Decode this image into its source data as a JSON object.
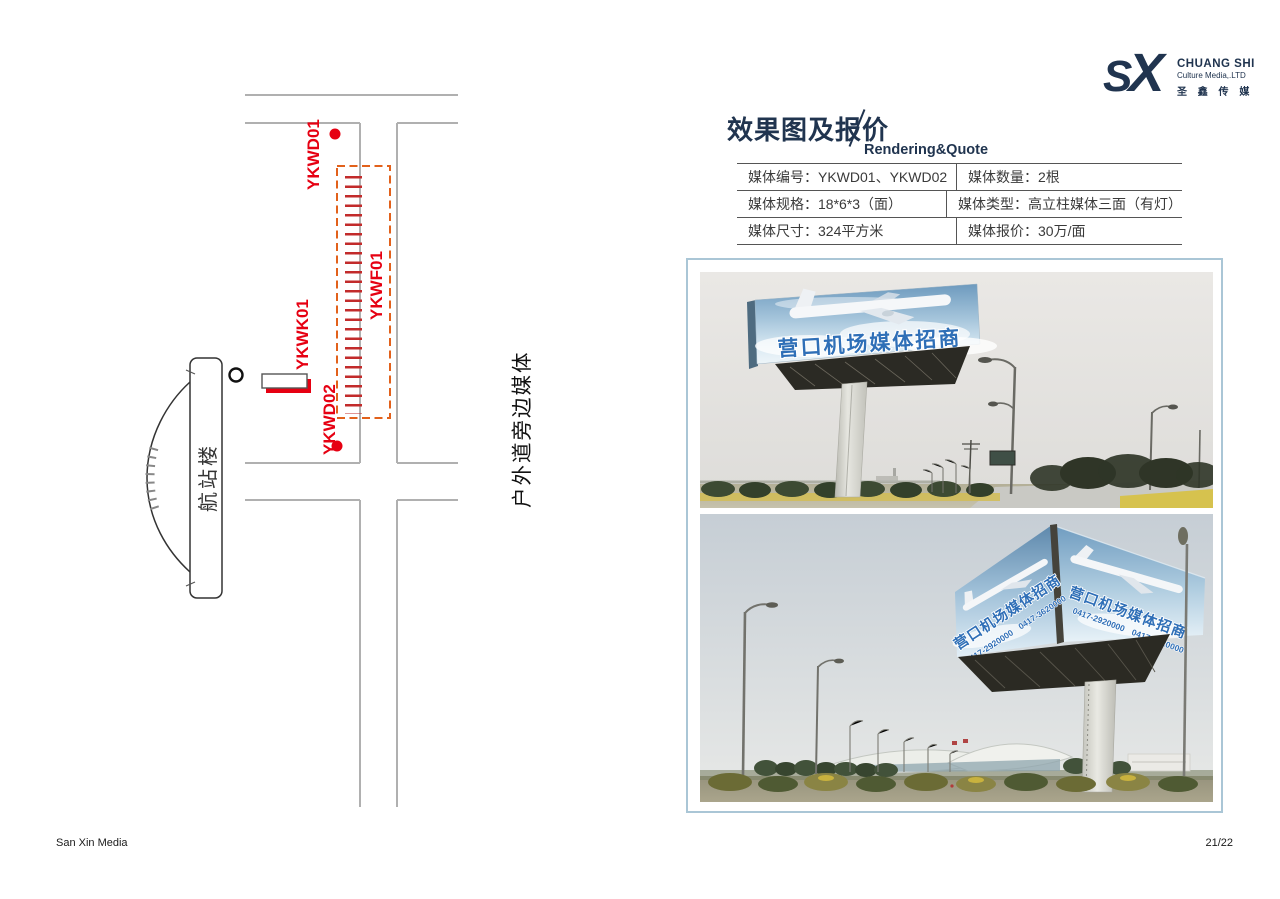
{
  "page": {
    "footer_left": "San Xin Media",
    "page_number": "21/22"
  },
  "logo": {
    "monogram_s": "S",
    "monogram_x": "X",
    "company_en": "CHUANG SHI",
    "company_sub": "Culture Media,.LTD",
    "company_zh": "圣 鑫 传 媒",
    "color": "#20344f"
  },
  "header": {
    "title_zh": "效果图及报价",
    "title_en": "Rendering&Quote"
  },
  "quote_table": {
    "rows": [
      {
        "l_label": "媒体编号：",
        "l_value": "YKWD01、YKWD02",
        "r_label": "媒体数量：",
        "r_value": "2根"
      },
      {
        "l_label": "媒体规格：",
        "l_value": "18*6*3（面）",
        "r_label": "媒体类型：",
        "r_value": "高立柱媒体三面（有灯）"
      },
      {
        "l_label": "媒体尺寸：",
        "l_value": "324平方米",
        "r_label": "媒体报价：",
        "r_value": "30万/面"
      }
    ]
  },
  "map": {
    "labels": {
      "point1": "YKWD01",
      "fence": "YKWF01",
      "board": "YKWK01",
      "point2": "YKWD02",
      "terminal": "航站楼",
      "roadside": "户外道旁边媒体"
    },
    "colors": {
      "marker_red": "#e60012",
      "fence_red": "#c22b2b",
      "dash_orange": "#e2611b",
      "road_gray": "#b0b0b0"
    }
  },
  "photos": {
    "billboard_text": "营口机场媒体招商",
    "phone1": "0417-2920000",
    "phone2": "0417-3620000"
  }
}
